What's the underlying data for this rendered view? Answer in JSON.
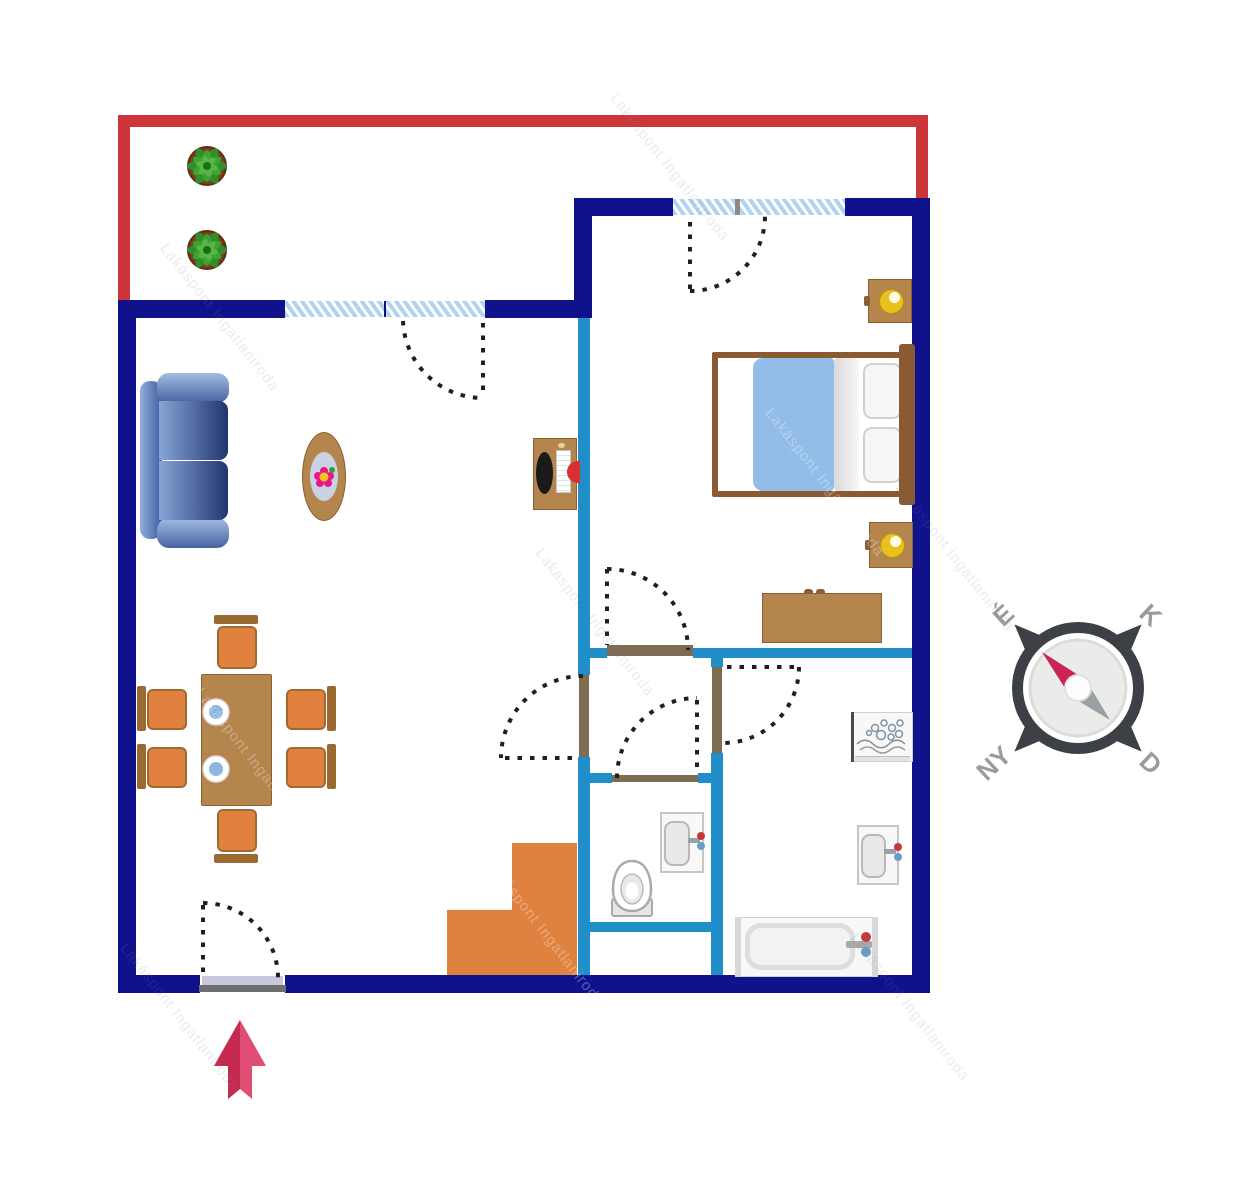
{
  "title": "Apartment floor plan",
  "compass": {
    "labels": {
      "north": "É",
      "east": "K",
      "south": "D",
      "west": "NY"
    }
  },
  "watermark": {
    "text": "Lakáspont Ingatlaniroda"
  },
  "icons": [
    "plant-icon",
    "sofa-icon",
    "coffee-table-icon",
    "dining-table-icon",
    "chair-icon",
    "plate-icon",
    "desk-icon",
    "bed-icon",
    "nightstand-icon",
    "lamp-icon",
    "dresser-icon",
    "washing-machine-icon",
    "sink-icon",
    "toilet-icon",
    "bathtub-icon",
    "stairs-icon",
    "door-swing-icon",
    "window-icon",
    "compass-icon",
    "entrance-arrow-icon"
  ],
  "colors": {
    "wall_navy": "#10128c",
    "interior_wall": "#1f8ec9",
    "balcony_red": "#ce353a",
    "window_stripe": "#aed4ef",
    "wood": "#b5854e",
    "wood_dark": "#8a5f33",
    "chair_orange": "#e0813f",
    "stairs_orange": "#e0823f",
    "bed_blanket": "#92bde9",
    "sofa_light": "#a3bce4",
    "sofa_dark": "#22346e",
    "arrow_dark": "#c62950",
    "arrow_light": "#e14e74",
    "compass_ring": "#3d4145",
    "compass_needle": "#c92454",
    "compass_gray": "#9aa0a4",
    "compass_label": "#9b9b9b",
    "door_arc": "#1f1f1f",
    "threshold_brown": "#7d6c52"
  }
}
